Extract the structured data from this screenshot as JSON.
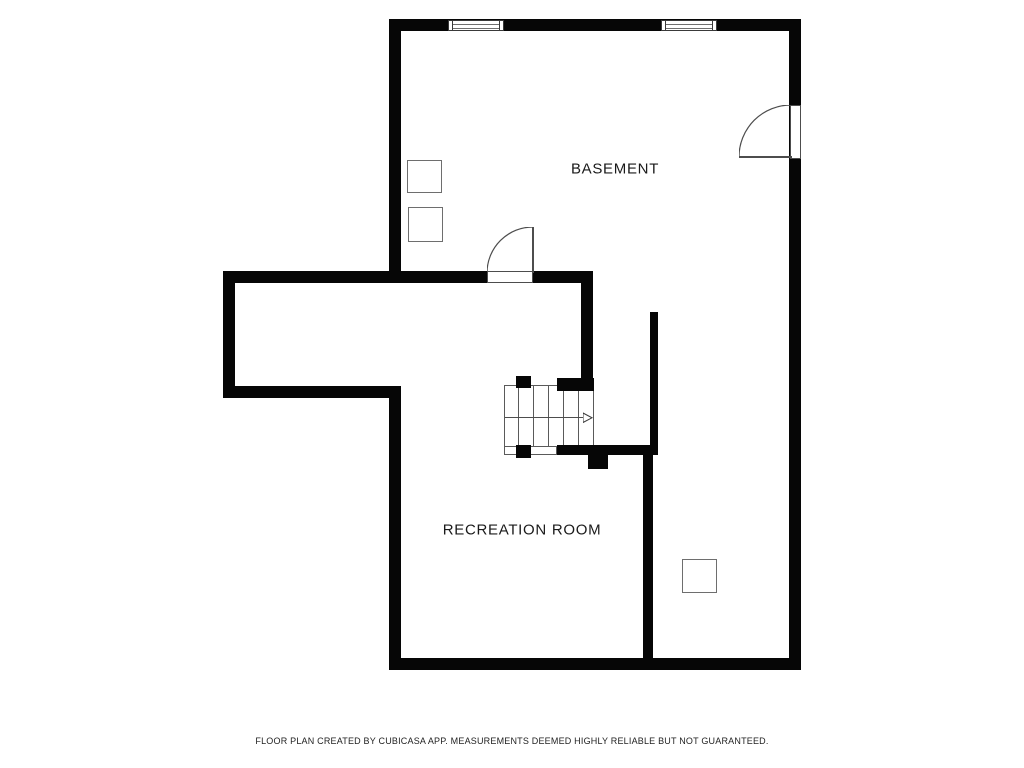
{
  "rooms": [
    {
      "id": "basement",
      "label": "BASEMENT"
    },
    {
      "id": "recreation-room",
      "label": "RECREATION ROOM"
    }
  ],
  "footer": {
    "disclaimer": "FLOOR PLAN CREATED BY CUBICASA APP. MEASUREMENTS DEEMED HIGHLY RELIABLE BUT NOT GUARANTEED."
  },
  "symbols": {
    "windows": [
      "window-top-left",
      "window-top-right"
    ],
    "doors": [
      "door-basement-right",
      "door-hallway"
    ],
    "stairs": "staircase-with-direction-arrow",
    "fixtures": [
      "fixture-square-basement-1",
      "fixture-square-basement-2",
      "fixture-square-recreation"
    ]
  },
  "colors": {
    "wall": "#060606",
    "thin_line": "#4d4d4d",
    "text": "#1a1a1a",
    "background": "#ffffff"
  }
}
